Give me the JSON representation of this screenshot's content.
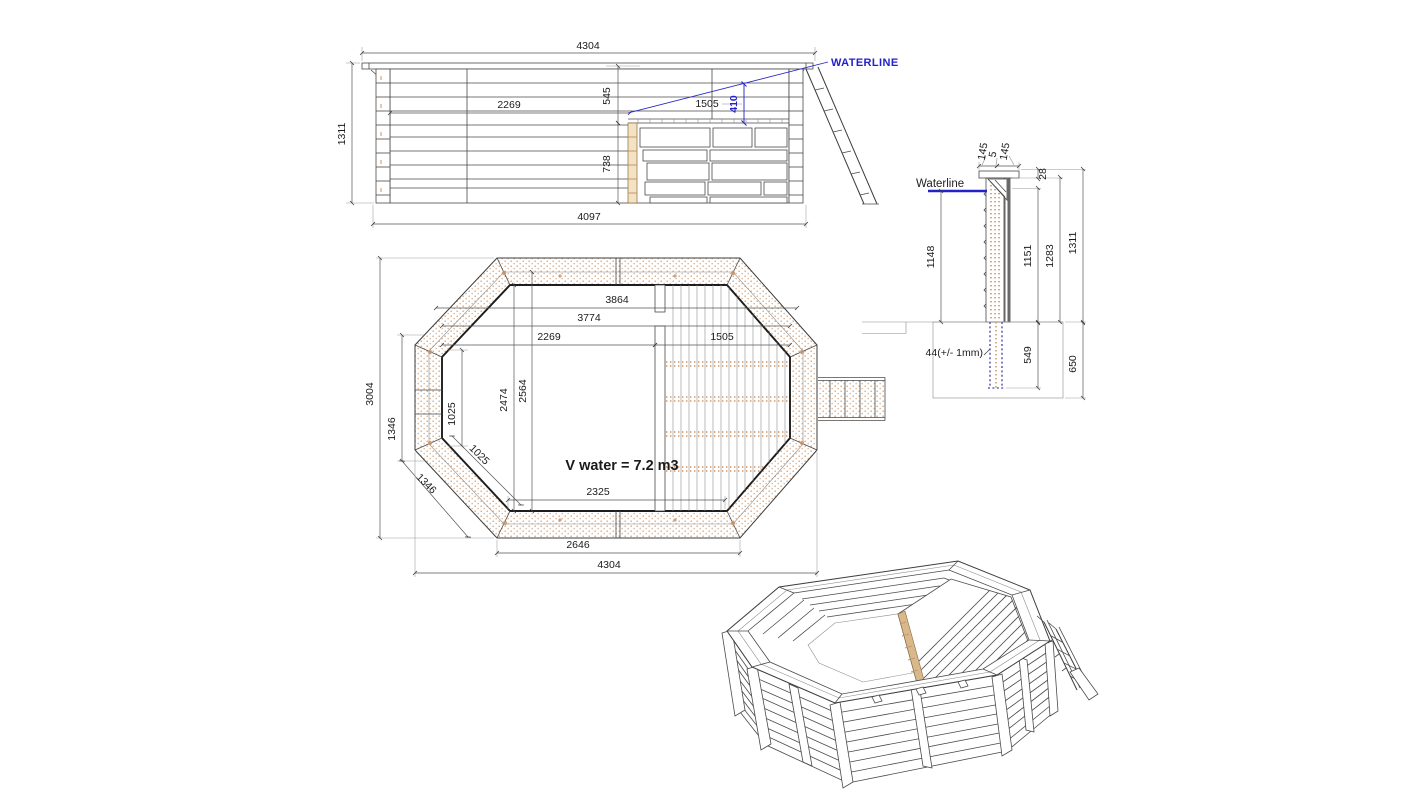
{
  "drawing": {
    "subject": "octagonal wooden pool technical drawing",
    "colors": {
      "line": "#3d3d3d",
      "text": "#1b1b1b",
      "accent_blue": "#2222c8",
      "wood_dot": "#c8956a",
      "wood_fill": "#f3e3c4",
      "ground_post": "#6565b2"
    }
  },
  "side_elevation": {
    "waterline_label": "WATERLINE",
    "dim_overall_width": "4304",
    "dim_overall_height": "1311",
    "dim_left_span": "2269",
    "dim_upper_height": "545",
    "dim_deck_span": "1505",
    "dim_waterline_to_deck": "410",
    "dim_lower_height": "738",
    "dim_base_width": "4097"
  },
  "cross_section": {
    "waterline_label": "Waterline",
    "dim_cap_outer": "145",
    "dim_cap_gap": "5",
    "dim_cap_inner": "145",
    "dim_cap_thickness": "28",
    "dim_water_depth": "1148",
    "dim_height_inner": "1151",
    "dim_height_mid": "1283",
    "dim_height_total": "1311",
    "dim_plank": "44(+/- 1mm)",
    "dim_post_embed": "549",
    "dim_ground_depth": "650"
  },
  "plan_view": {
    "volume_label": "V water = 7.2 m3",
    "dim_width_top": "3864",
    "dim_width_second": "3774",
    "dim_left_to_deck": "2269",
    "dim_deck_width": "1505",
    "dim_overall_height": "3004",
    "dim_side_left": "1346",
    "dim_side_diag": "1346",
    "dim_inner_height": "2564",
    "dim_inner_height2": "2474",
    "dim_seat_vert": "1025",
    "dim_seat_diag": "1025",
    "dim_bottom_inner": "2325",
    "dim_bottom_edge": "2646",
    "dim_overall_width": "4304"
  }
}
